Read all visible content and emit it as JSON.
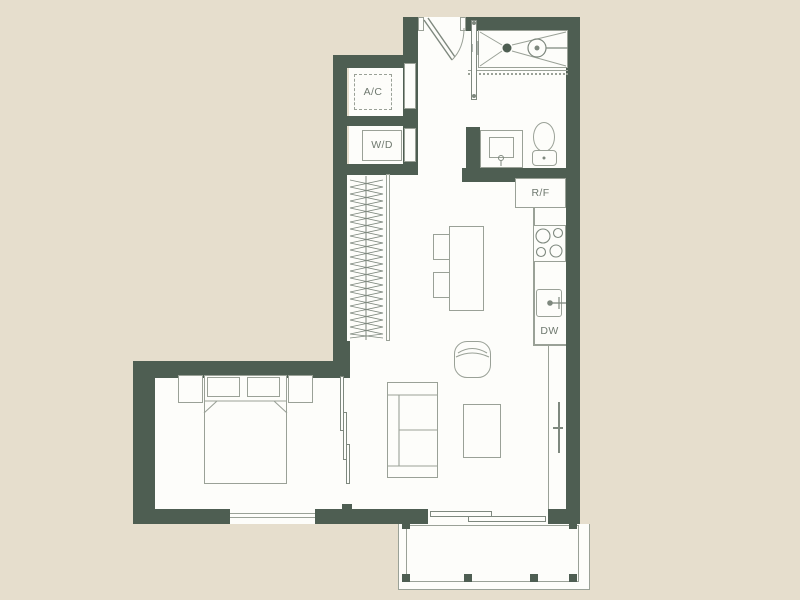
{
  "colors": {
    "background": "#e6decd",
    "wall": "#4e5e52",
    "line": "#9aa197",
    "line2": "#7e887e",
    "floor": "#fdfdfa",
    "text": "#6f796f"
  },
  "floorplan": {
    "labels": {
      "ac_closet": "A/C",
      "washer_dryer": "W/D",
      "refrigerator": "R/F",
      "dishwasher": "DW"
    }
  }
}
